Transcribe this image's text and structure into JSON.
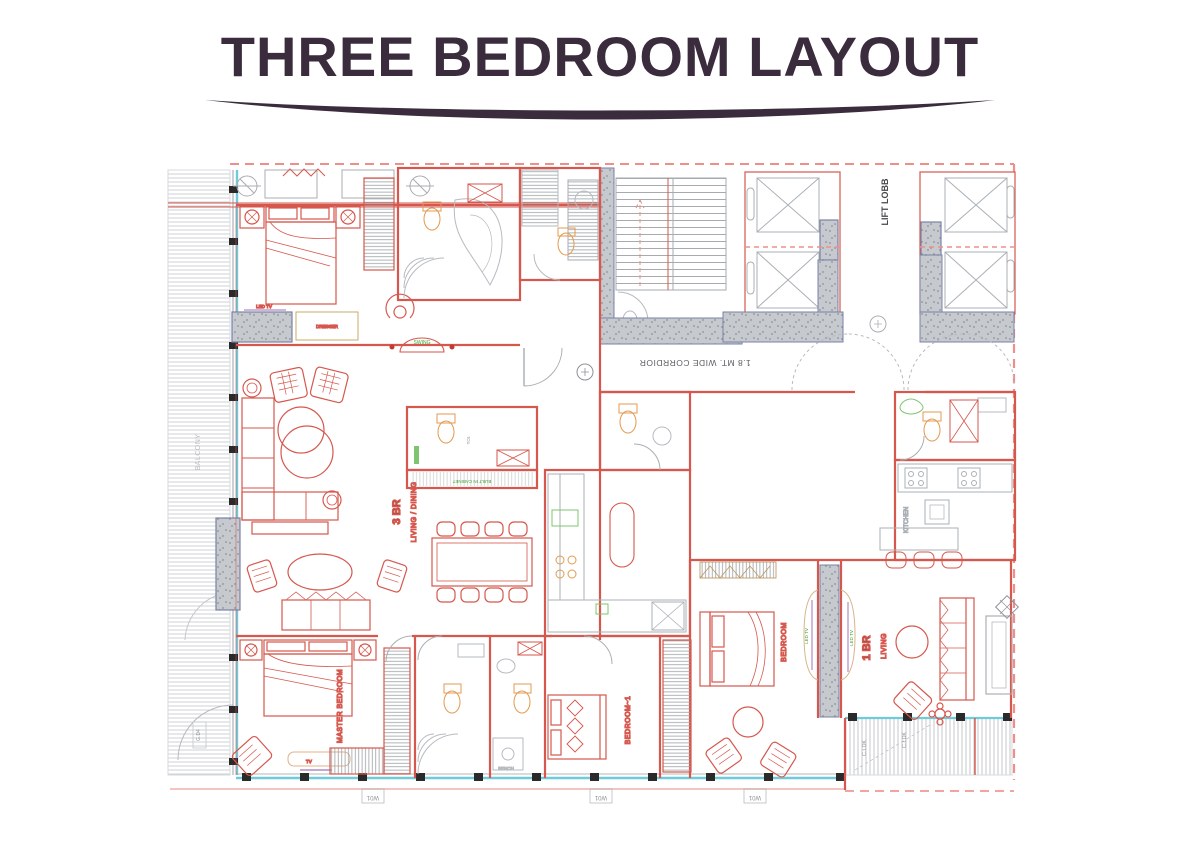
{
  "title": {
    "text": "THREE BEDROOM LAYOUT"
  },
  "plan": {
    "units": {
      "three_br": {
        "label": "3 BR",
        "sublabel": "LIVING / DINING"
      },
      "one_br": {
        "label": "1 BR",
        "sublabel": "LIVING"
      }
    },
    "rooms": {
      "corridor": "1.8 MT. WIDE CORRDIOR",
      "lift_lobby": "LIFT LOBB",
      "master_bedroom": "MASTER BEDROOM",
      "bedroom_1": "BEDROOM~1",
      "bedroom": "BEDROOM",
      "kitchen": "KITCHEN",
      "balcony": "BALCONY",
      "toilet": "TOI."
    },
    "tags": {
      "led_tv": "LED TV",
      "dresser": "DRESSER",
      "built_in_cabinet": "BUILT IN CABINET",
      "swing": "SWING",
      "tv": "TV",
      "bench": "BENCH",
      "window": "W01",
      "deck": "C.LDK",
      "door": "G.D4"
    },
    "colors": {
      "title": "#3a2b3d",
      "wall_red": "#d6574d",
      "label_green": "#3fa32e",
      "glass_cyan": "#6fcbd9",
      "wall_gray": "#c6c9cd",
      "boundary_dash": "#ef8f8a",
      "fixture_orange": "#e39a4d"
    }
  }
}
